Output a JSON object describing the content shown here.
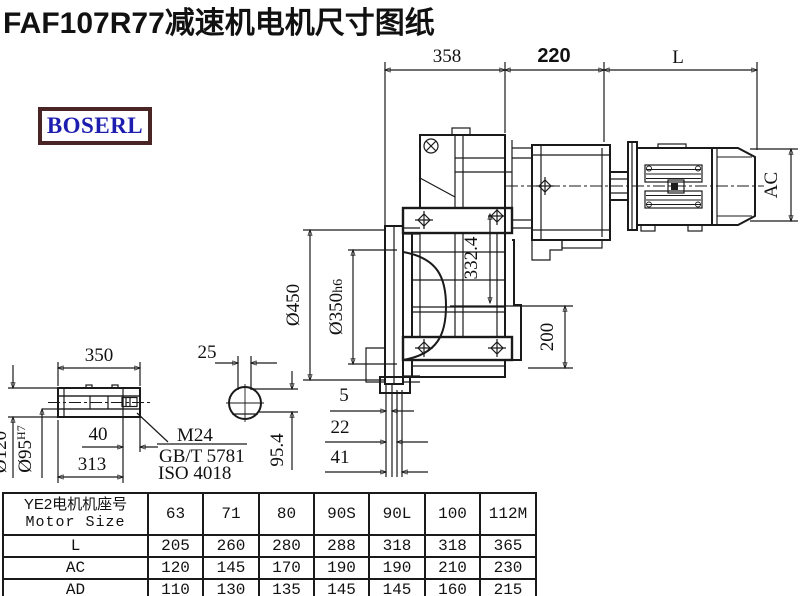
{
  "title": "FAF107R77减速机电机尺寸图纸",
  "logo": "BOSERL",
  "colors": {
    "line": "#1a1a1a",
    "title_text": "#111111",
    "logo_border": "#4a2525",
    "logo_text": "#1d1db0",
    "background": "#ffffff"
  },
  "dims": {
    "gearbox_width": "358",
    "adapter_width": "220",
    "motor_length": "L",
    "motor_diameter": "AC",
    "flange_od": "Ø450",
    "flange_spigot": "Ø350",
    "flange_spigot_tol": "h6",
    "axis_height": "332.4",
    "lower_height": "200",
    "face_gap_small": "5",
    "face_gap_mid": "22",
    "face_gap_large": "41",
    "shaft_length": "350",
    "shaft_od": "Ø120",
    "bore_dia": "Ø95",
    "bore_tol": "H7",
    "bore_step": "40",
    "bore_depth": "313",
    "key_width": "25",
    "key_height": "95.4",
    "bolt_label": "M24",
    "bolt_std_gb": "GB/T 5781",
    "bolt_std_iso": "ISO 4018"
  },
  "table": {
    "header_line1": "YE2电机机座号",
    "header_line2": "Motor Size",
    "col_headers": [
      "63",
      "71",
      "80",
      "90S",
      "90L",
      "100",
      "112M"
    ],
    "rows": [
      {
        "label": "L",
        "values": [
          "205",
          "260",
          "280",
          "288",
          "318",
          "318",
          "365"
        ]
      },
      {
        "label": "AC",
        "values": [
          "120",
          "145",
          "170",
          "190",
          "190",
          "210",
          "230"
        ]
      },
      {
        "label": "AD",
        "values": [
          "110",
          "130",
          "135",
          "145",
          "145",
          "160",
          "215"
        ]
      }
    ]
  }
}
